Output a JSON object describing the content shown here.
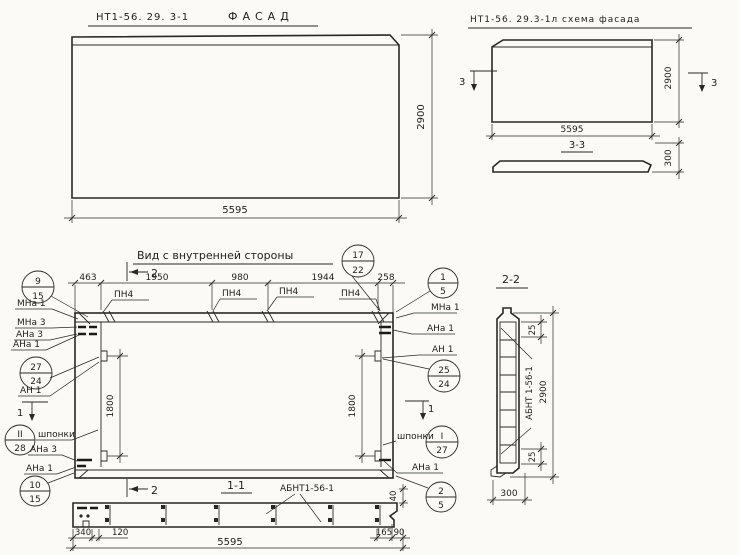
{
  "facade": {
    "title_code": "НТ1-56. 29. 3-1",
    "title_name": "ФАСАД",
    "dim_width": "5595",
    "dim_height": "2900"
  },
  "schema": {
    "title": "НТ1-56. 29.3-1л схема фасада",
    "dim_width": "5595",
    "dim_height": "2900",
    "dim_thickness": "300",
    "section_label": "3-3",
    "cut_label": "3"
  },
  "inner_view": {
    "title": "Вид с внутренней стороны",
    "top_dims": [
      "463",
      "1950",
      "980",
      "1944",
      "258"
    ],
    "side_dim_left": "1800",
    "side_dim_right": "1800",
    "pn4_labels": [
      "ПН4",
      "ПН4",
      "ПН4",
      "ПН4"
    ],
    "cut1_label": "1",
    "cut2_label": "2",
    "keys_label_left": "шпонки",
    "keys_label_right": "шпонки",
    "left_labels": [
      "МНа 1",
      "МНа 3",
      "АНа 3",
      "АНа 1",
      "АН 1",
      "АНа 3",
      "АНа 1"
    ],
    "right_labels": [
      "МНа 1",
      "АНа 1",
      "АН 1",
      "АНа 1"
    ],
    "balloons": {
      "b9_15": {
        "top": "9",
        "bottom": "15"
      },
      "b17_22": {
        "top": "17",
        "bottom": "22"
      },
      "b1_5": {
        "top": "1",
        "bottom": "5"
      },
      "b27_24": {
        "top": "27",
        "bottom": "24"
      },
      "b25_24": {
        "top": "25",
        "bottom": "24"
      },
      "bII_28": {
        "top": "II",
        "bottom": "28"
      },
      "bI_27": {
        "top": "I",
        "bottom": "27"
      },
      "b10_15": {
        "top": "10",
        "bottom": "15"
      },
      "b2_5": {
        "top": "2",
        "bottom": "5"
      }
    }
  },
  "section_1_1": {
    "label": "1-1",
    "part_label": "АБНТ1-56-1",
    "dims": {
      "d340": "340",
      "d120": "120",
      "d5595": "5595",
      "d165": "165",
      "d90": "90",
      "d40": "40"
    }
  },
  "section_2_2": {
    "label": "2-2",
    "part_label": "АБНТ 1-56-1",
    "dims": {
      "d25_top": "25",
      "d2900": "2900",
      "d25_bottom": "25",
      "d300": "300"
    }
  }
}
